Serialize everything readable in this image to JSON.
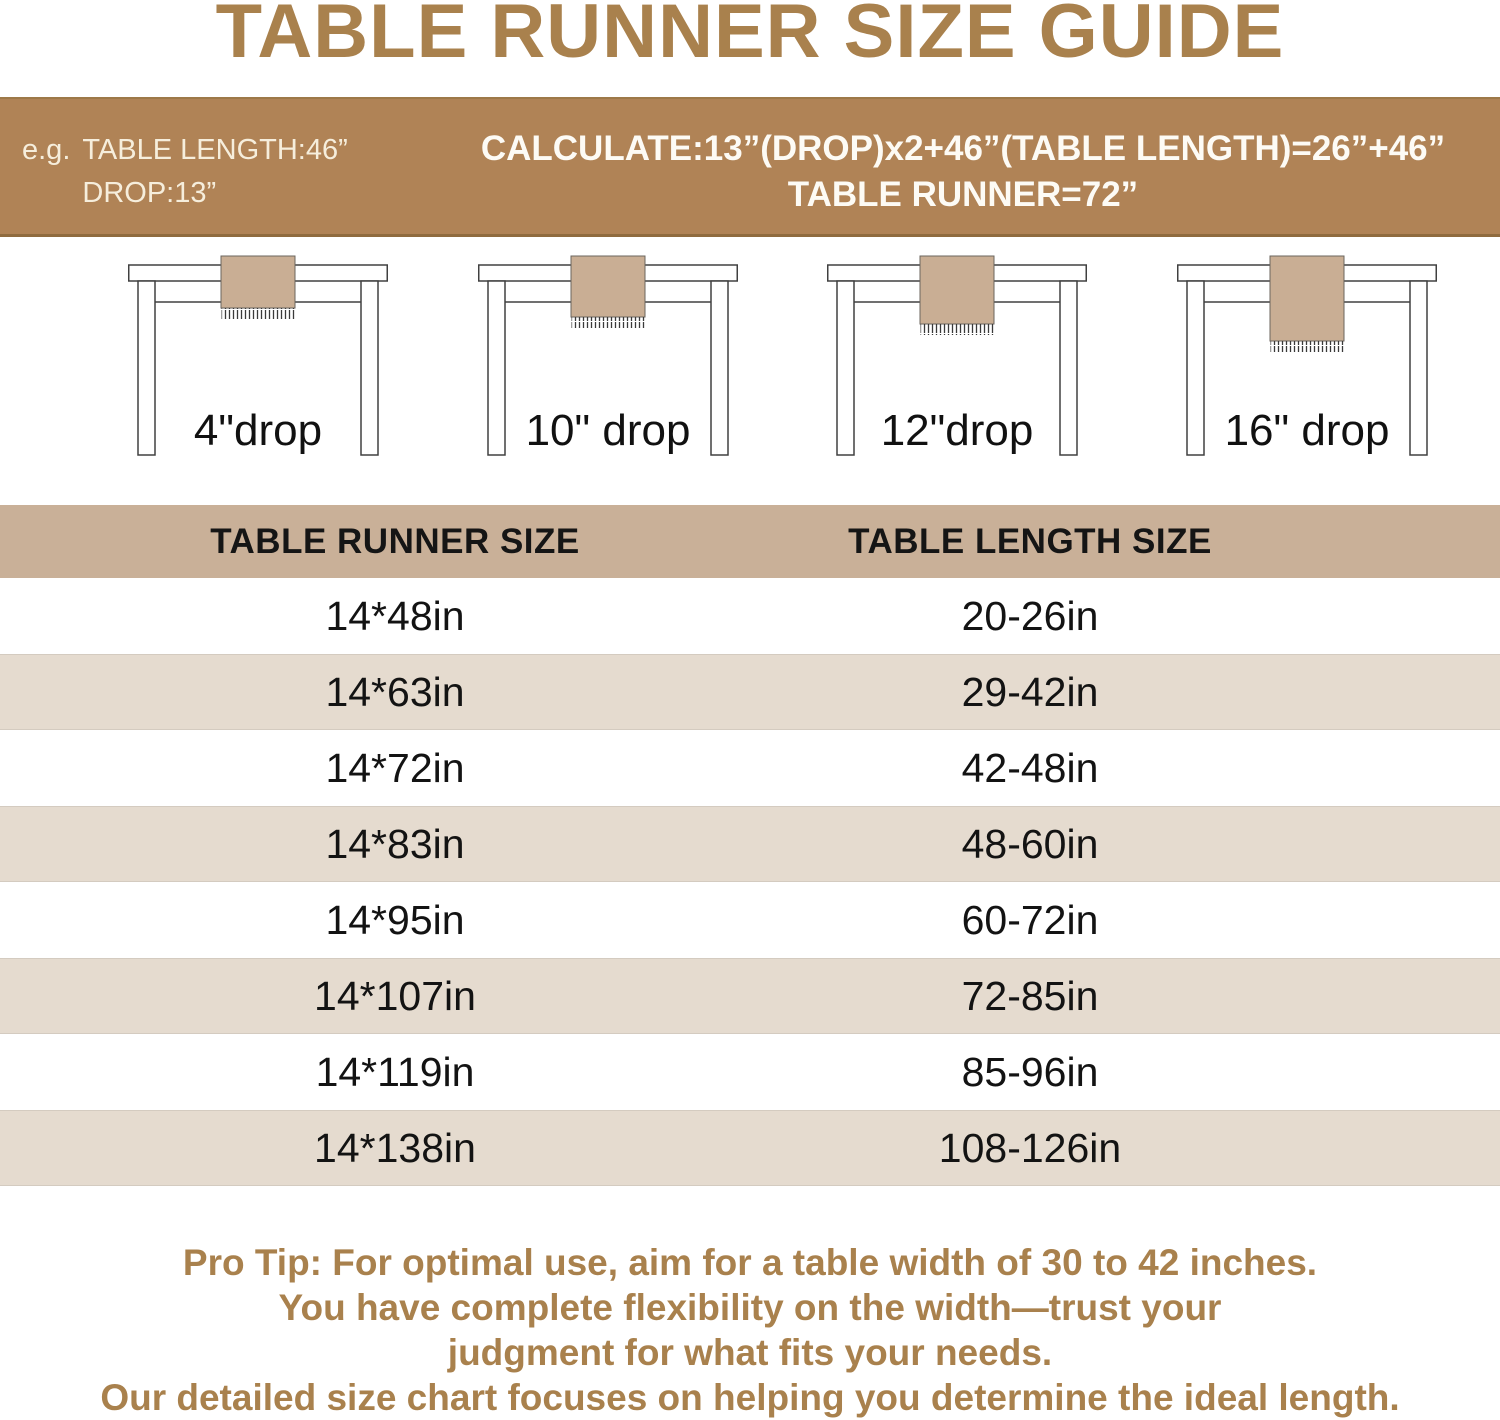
{
  "title": "TABLE RUNNER SIZE GUIDE",
  "banner": {
    "example_prefix": "e.g.",
    "example_line1": "TABLE LENGTH:46”",
    "example_line2": "DROP:13”",
    "calc_line1": "CALCULATE:13”(DROP)x2+46”(TABLE LENGTH)=26”+46”",
    "calc_line2": "TABLE RUNNER=72”"
  },
  "figures": [
    {
      "label": "4\"drop"
    },
    {
      "label": "10\" drop"
    },
    {
      "label": "12\"drop"
    },
    {
      "label": "16\" drop"
    }
  ],
  "size_table": {
    "headers": [
      "TABLE RUNNER SIZE",
      "TABLE LENGTH SIZE"
    ],
    "rows": [
      [
        "14*48in",
        "20-26in"
      ],
      [
        "14*63in",
        "29-42in"
      ],
      [
        "14*72in",
        "42-48in"
      ],
      [
        "14*83in",
        "48-60in"
      ],
      [
        "14*95in",
        "60-72in"
      ],
      [
        "14*107in",
        "72-85in"
      ],
      [
        "14*119in",
        "85-96in"
      ],
      [
        "14*138in",
        "108-126in"
      ]
    ]
  },
  "pro_tip": {
    "lines": [
      "Pro Tip: For optimal use, aim for a table width of 30 to 42 inches.",
      "You have complete flexibility on the width—trust your",
      "judgment for what fits your needs.",
      "Our detailed size chart focuses on helping you determine the ideal length."
    ]
  },
  "chart_data": {
    "type": "table",
    "title": "TABLE RUNNER SIZE GUIDE",
    "columns": [
      "TABLE RUNNER SIZE",
      "TABLE LENGTH SIZE"
    ],
    "rows": [
      [
        "14*48in",
        "20-26in"
      ],
      [
        "14*63in",
        "29-42in"
      ],
      [
        "14*72in",
        "42-48in"
      ],
      [
        "14*83in",
        "48-60in"
      ],
      [
        "14*95in",
        "60-72in"
      ],
      [
        "14*107in",
        "72-85in"
      ],
      [
        "14*119in",
        "85-96in"
      ],
      [
        "14*138in",
        "108-126in"
      ]
    ],
    "drops_illustrated": [
      "4\"drop",
      "10\" drop",
      "12\"drop",
      "16\" drop"
    ],
    "example_formula": "13”(DROP)x2+46”(TABLE LENGTH)=26”+46” → TABLE RUNNER=72”"
  },
  "colors": {
    "accent_brown": "#A9814D",
    "banner_bg": "#B08356",
    "banner_text": "#F6EEDC",
    "header_band_bg": "#C9B098",
    "row_alt_bg": "#E5DBCF",
    "runner_fill": "#C9AE94",
    "table_outline": "#404040",
    "row_text": "#131313"
  }
}
